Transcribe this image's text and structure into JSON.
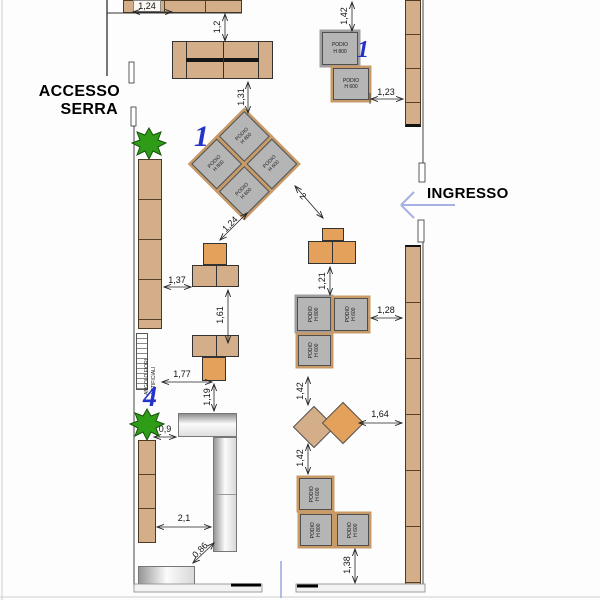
{
  "scene": {
    "type": "retail floor plan"
  },
  "labels": {
    "accesso_line1": "ACCESSO",
    "accesso_line2": "SERRA",
    "ingresso": "INGRESSO",
    "corner_line1": "ANGOLO FIORI",
    "corner_line2": "ARTIFICIALI",
    "marker_podio_pair": "1",
    "marker_diamond": "1",
    "marker_corner": "4"
  },
  "podio": {
    "h800_line1": "PODIO",
    "h800_line2": "H 800",
    "h600_line1": "PODIO",
    "h600_line2": "H 600"
  },
  "dimensions": {
    "top_shelf": "1,24",
    "shelf_to_sofa": "1,2",
    "wall_to_podio_tr": "1,42",
    "podio_tr_to_wall": "1,23",
    "sofa_to_diamond": "1,31",
    "diamond_to_podium": "1,24",
    "diamond_to_t_right": "2",
    "wall_to_t1": "1,37",
    "t1_to_t2": "1,61",
    "t_right_to_cluster": "1,21",
    "cluster_to_wall": "1,28",
    "wall_to_t2": "1,77",
    "t2_to_counter": "1,19",
    "cluster_to_diamonds": "1,42",
    "diamonds_to_cluster2": "1,42",
    "diamonds_to_wall": "1,64",
    "plant_to_counter": "0,9",
    "wall_to_counter": "2,1",
    "counter_gap": "0,86",
    "cluster2_to_floor": "1,38"
  },
  "colors": {
    "shelf_tan": "#d3ae88",
    "podium_orange": "#e3a15b",
    "podio_gray": "#b5b5b5",
    "podio_border_tan": "#c89a66",
    "marker_blue": "#2433c8",
    "arrow_blue": "#a7b0e3",
    "plant_green": "#2f9c18"
  }
}
